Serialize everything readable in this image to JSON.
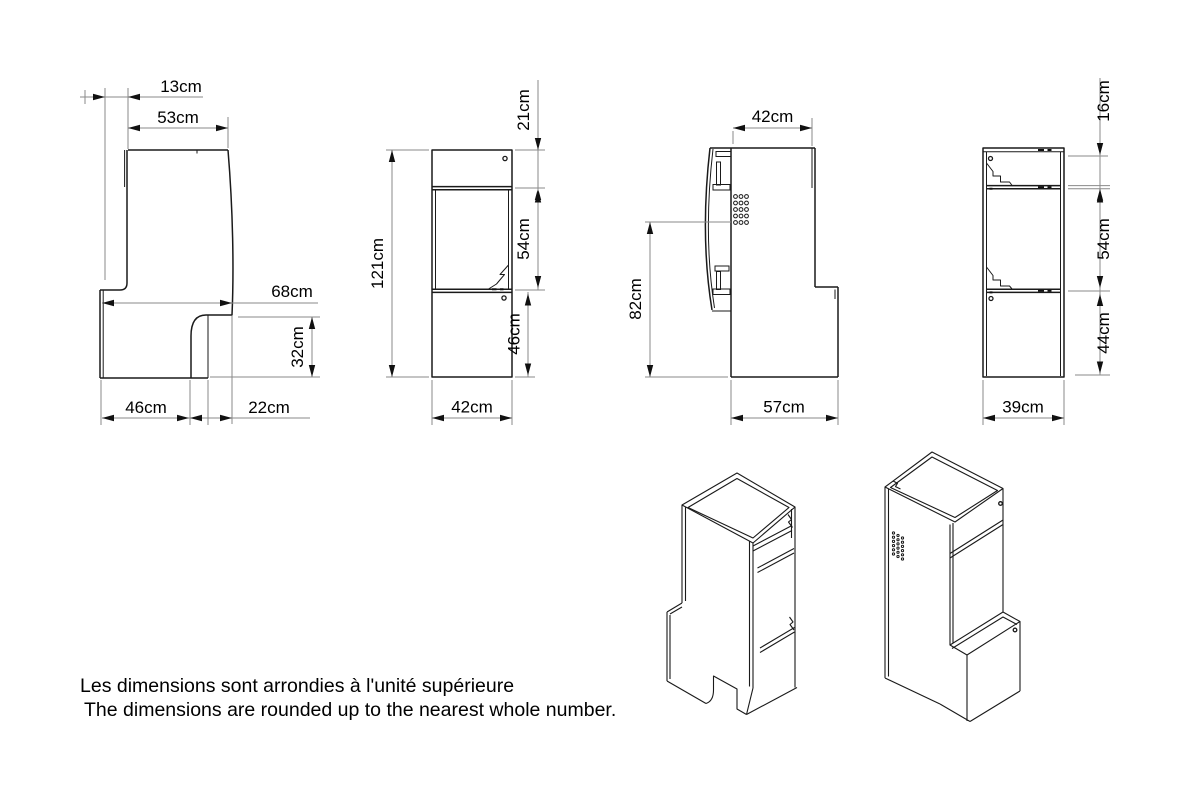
{
  "drawing": {
    "note": {
      "fr": "Les dimensions sont arrondies à l'unité supérieure",
      "en": "The dimensions are rounded up to the nearest whole number."
    },
    "views": {
      "side_a": {
        "dims": {
          "top_offset": "13cm",
          "top_width": "53cm",
          "depth": "68cm",
          "step_height": "32cm",
          "bottom_front": "46cm",
          "bottom_rear": "22cm"
        }
      },
      "front": {
        "dims": {
          "height": "121cm",
          "top_section": "21cm",
          "middle_section": "54cm",
          "bottom_section": "46cm",
          "width": "42cm"
        }
      },
      "side_b": {
        "dims": {
          "top_depth": "42cm",
          "worktop_height": "82cm",
          "bottom_depth": "57cm"
        }
      },
      "rear": {
        "dims": {
          "top_section": "16cm",
          "middle_section": "54cm",
          "bottom_section": "44cm",
          "width": "39cm"
        }
      }
    },
    "colors": {
      "outline": "#1a1a1a",
      "dimension_line": "#8a8a8a",
      "text": "#000000",
      "background": "#ffffff"
    }
  }
}
